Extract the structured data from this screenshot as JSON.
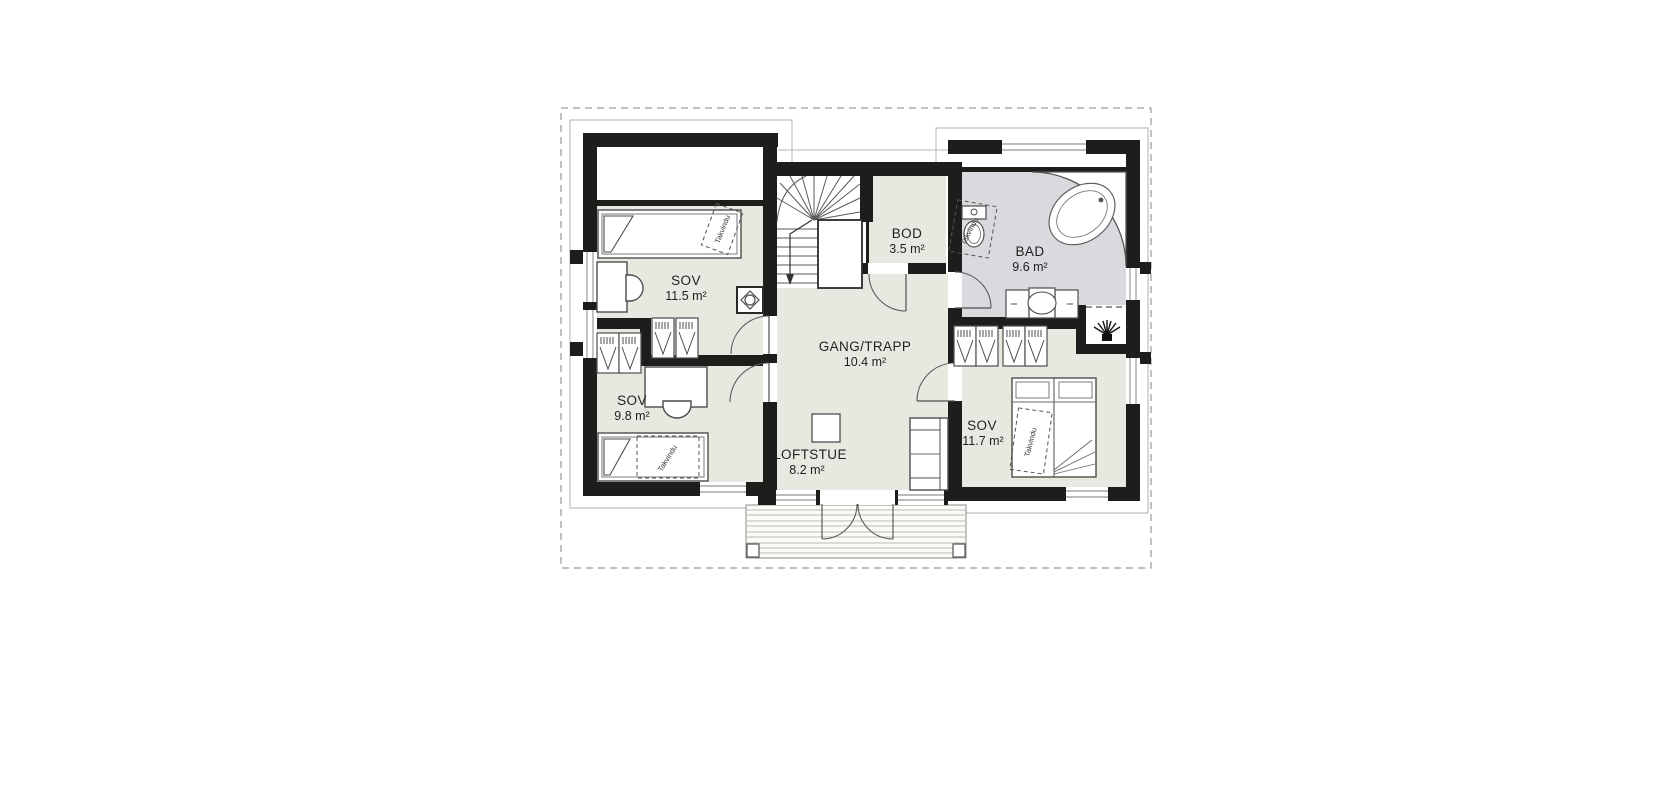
{
  "floorplan": {
    "rooms": [
      {
        "name": "SOV",
        "area": "11.5 m²"
      },
      {
        "name": "SOV",
        "area": "9.8 m²"
      },
      {
        "name": "BOD",
        "area": "3.5 m²"
      },
      {
        "name": "BAD",
        "area": "9.6 m²"
      },
      {
        "name": "GANG/TRAPP",
        "area": "10.4 m²"
      },
      {
        "name": "SOV",
        "area": "11.7 m²"
      },
      {
        "name": "LOFTSTUE",
        "area": "8.2 m²"
      }
    ],
    "roof_window_label": "Takvindu",
    "colors": {
      "wall": "#1d1d1b",
      "floor": "#e9e8e0",
      "bath_floor": "#d9dadd",
      "furniture_line": "#4d4d4d",
      "boundary": "#9a9a9a",
      "background": "#ffffff"
    },
    "icons": [
      "bed-icon",
      "desk-icon",
      "chair-icon",
      "wardrobe-icon",
      "chimney-icon",
      "stairs-icon",
      "toilet-icon",
      "bathtub-icon",
      "sink-vanity-icon",
      "sprinkler-icon",
      "sofa-icon",
      "coffee-table-icon",
      "french-door-icon",
      "deck-icon",
      "window-icon",
      "door-arc-icon"
    ]
  }
}
